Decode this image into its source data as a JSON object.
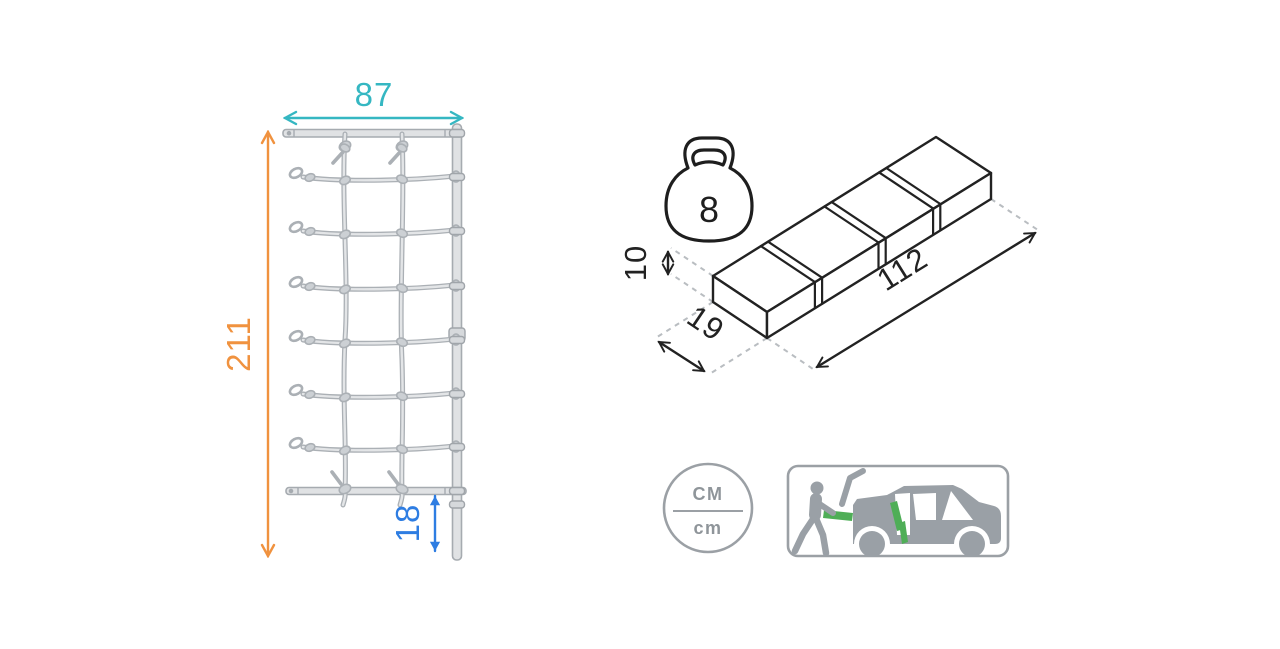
{
  "colors": {
    "dim-width": "#35b7c2",
    "dim-height": "#f0923f",
    "dim-gap": "#2e7de2",
    "icon-gray": "#9aa0a6",
    "accent-green": "#4fae57",
    "rope-outline": "#abb0b5",
    "rope-fill": "#e3e5e7",
    "leader-gray": "#b9bdc1"
  },
  "net_diagram": {
    "width_value": "87",
    "height_value": "211",
    "ground_clearance_value": "18"
  },
  "package": {
    "weight_value": "8",
    "length_value": "112",
    "depth_value": "19",
    "height_value": "10"
  },
  "units_badge": {
    "numerator": "CM",
    "denominator": "cm"
  }
}
